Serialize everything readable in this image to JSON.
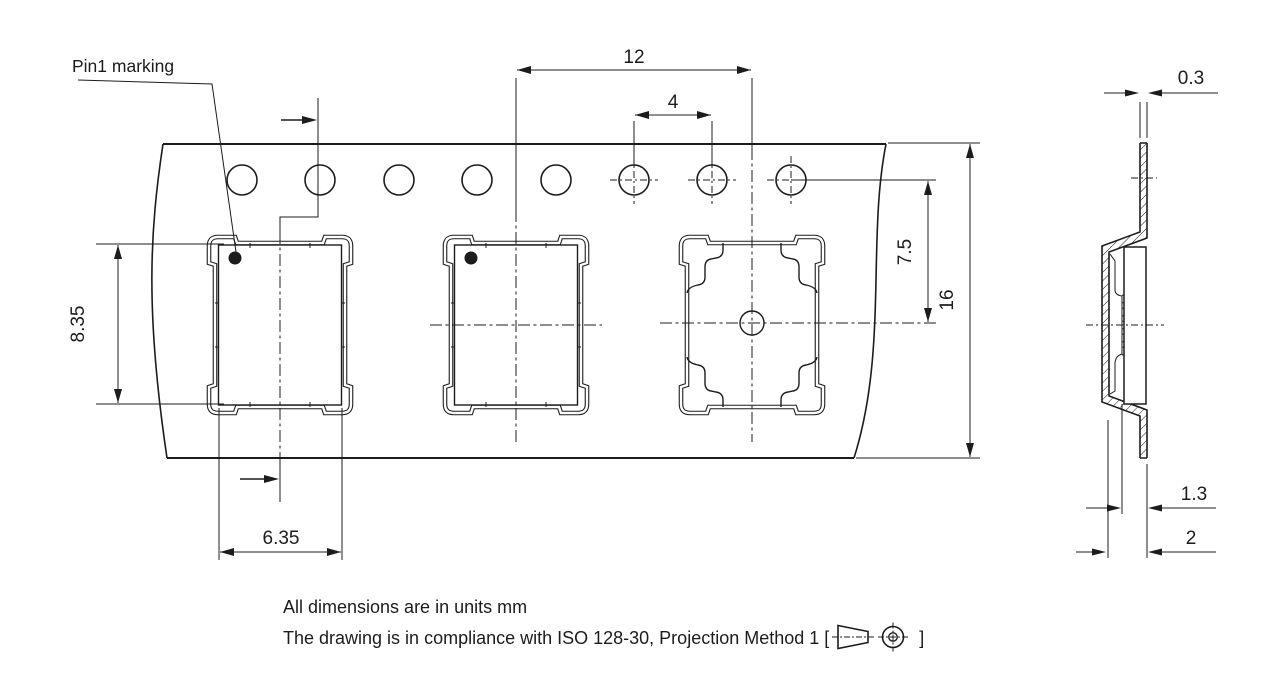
{
  "drawing_labels": {
    "pin1": "Pin1 marking"
  },
  "dimensions": {
    "pocket_pitch": "12",
    "sprocket_hole_pitch": "4",
    "tape_thickness": "0.3",
    "hole_to_pocket_center": "7.5",
    "tape_width": "16",
    "pocket_length": "8.35",
    "pocket_width": "6.35",
    "pocket_inner_depth": "1.3",
    "pocket_total_depth": "2"
  },
  "notes": {
    "units_line": "All dimensions are in units mm",
    "compliance_prefix": "The drawing is in compliance with ISO 128-30, Projection Method 1 [",
    "compliance_suffix": "]"
  },
  "colors": {
    "line": "#1c1c1c",
    "background": "#ffffff"
  }
}
